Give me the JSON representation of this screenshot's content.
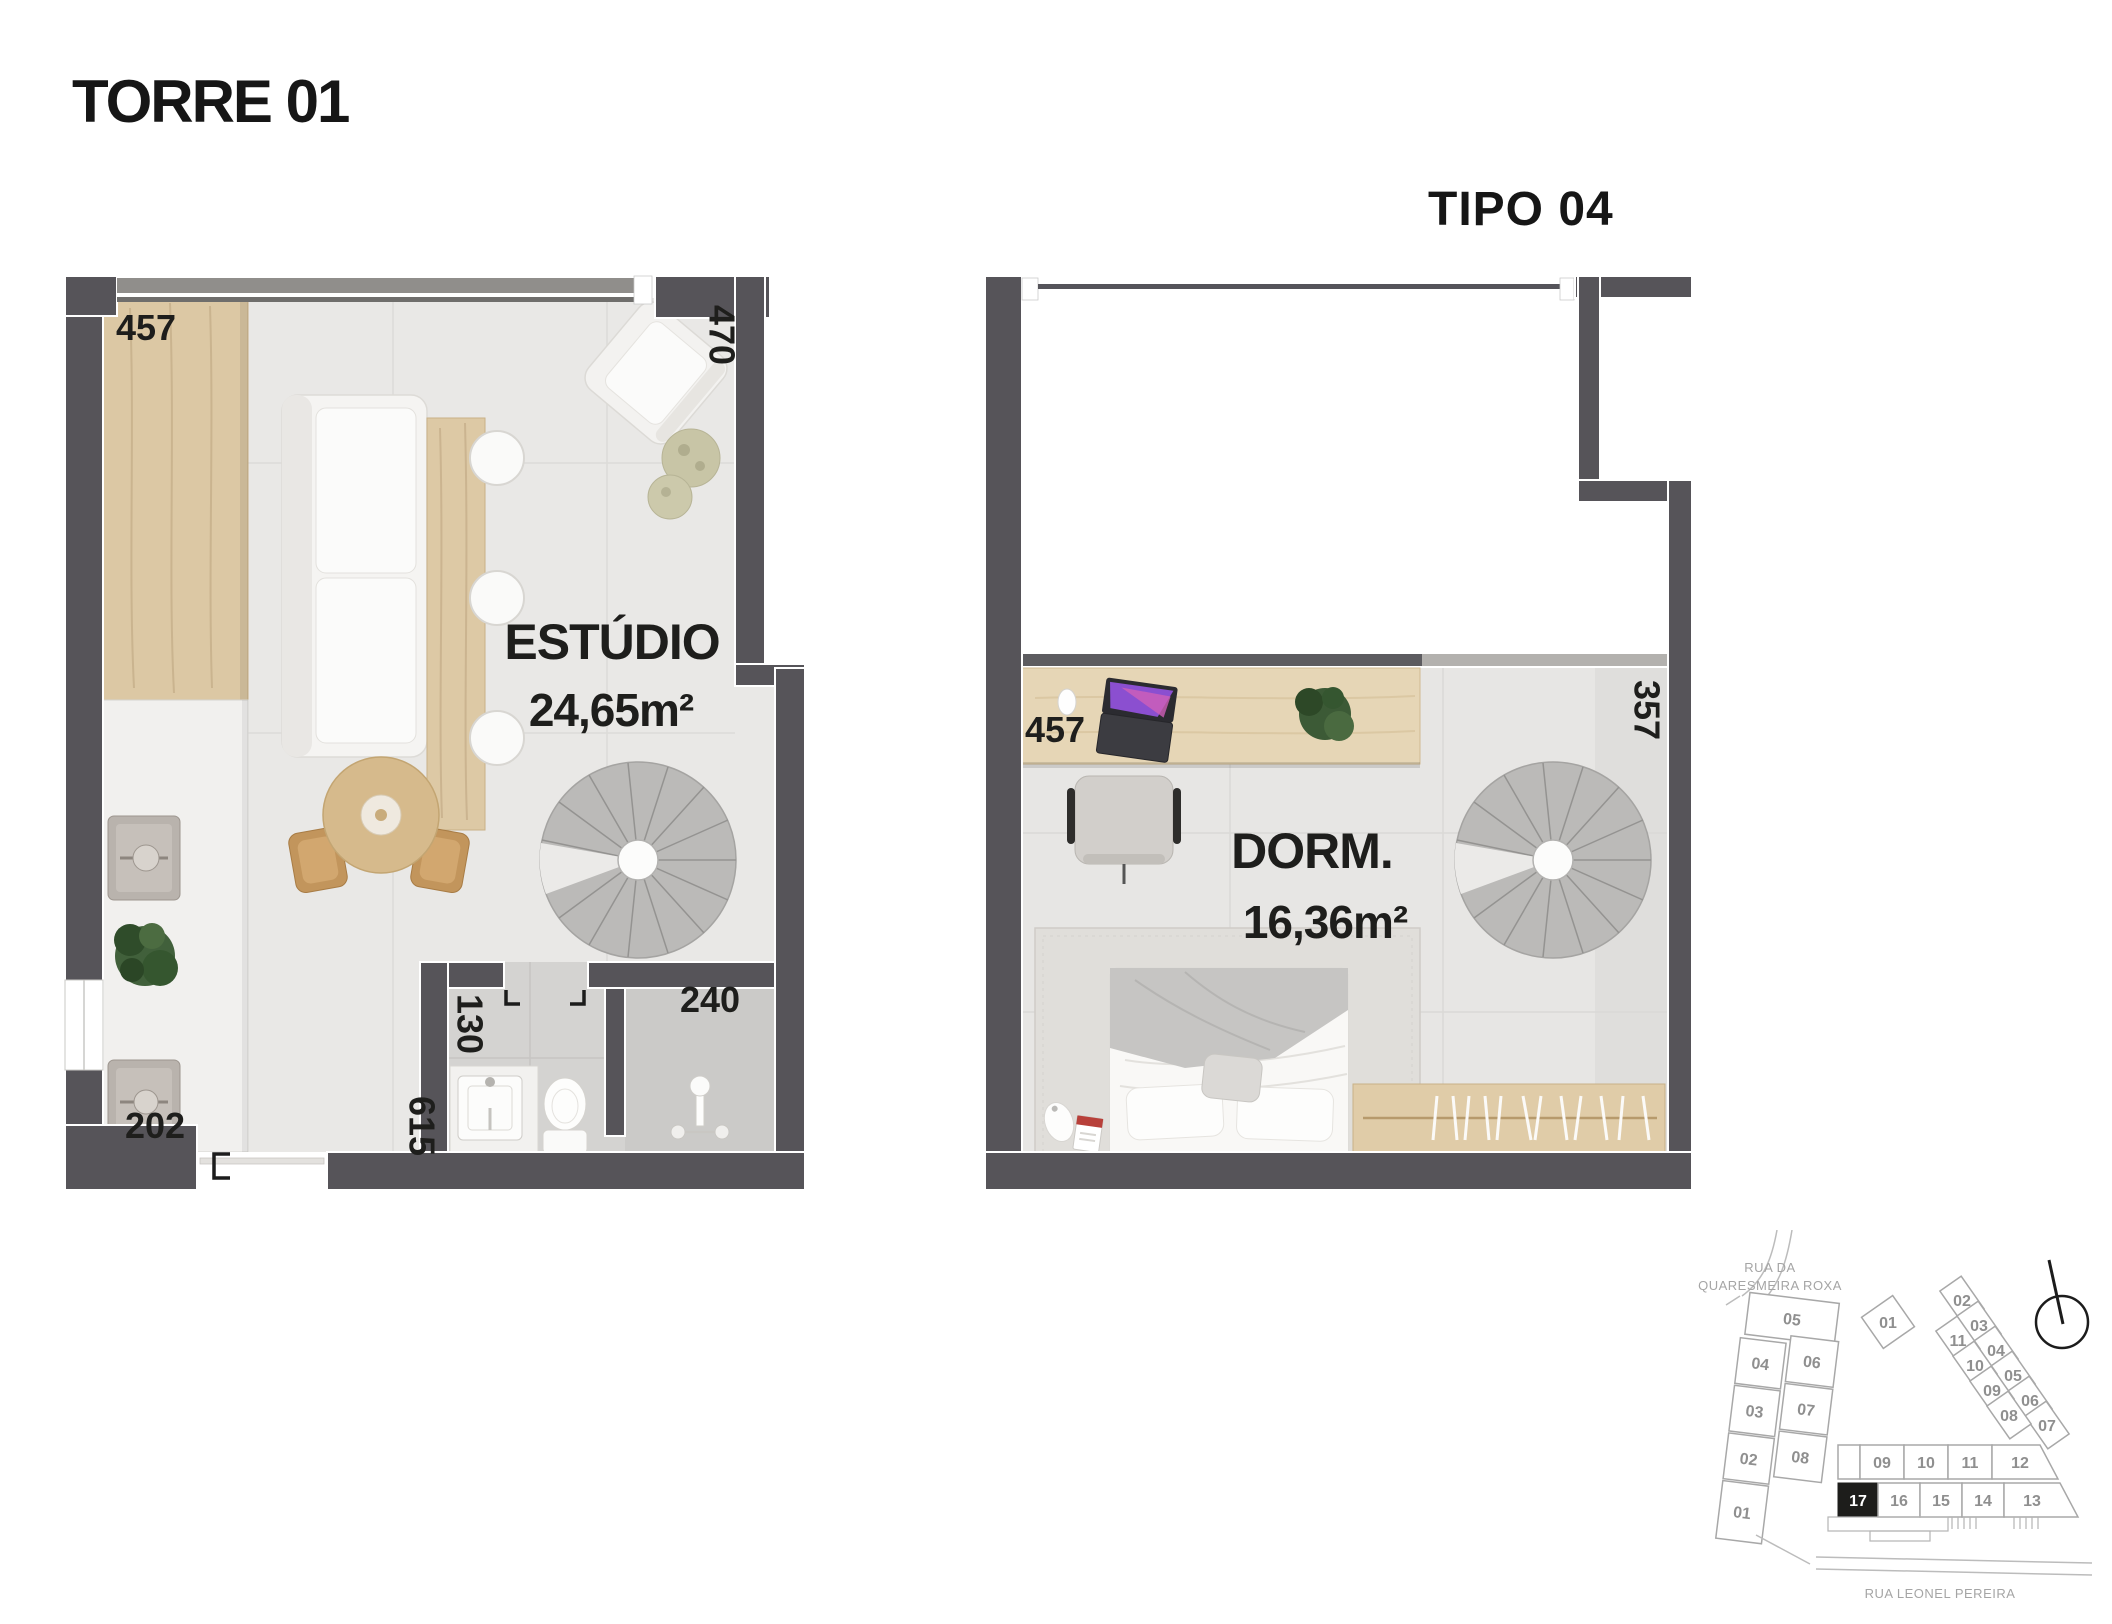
{
  "header": {
    "title": "TORRE 01",
    "type_label": "TIPO 04"
  },
  "studio_plan": {
    "room_label": "ESTÚDIO",
    "room_area": "24,65m²",
    "dim_top_counter": "457",
    "dim_right_wall": "470",
    "dim_bath_door": "130",
    "dim_shower": "240",
    "dim_kitchen_bottom": "202",
    "dim_hall": "615"
  },
  "bedroom_plan": {
    "room_label": "DORM.",
    "room_area": "16,36m²",
    "dim_desk_wall": "457",
    "dim_right_wall": "357"
  },
  "site_plan": {
    "street_top_line1": "RUA DA",
    "street_top_line2": "QUARESMEIRA ROXA",
    "street_bottom": "RUA LEONEL PEREIRA",
    "highlighted_unit": "17",
    "tower_left": {
      "u05": "05",
      "u04": "04",
      "u03": "03",
      "u02": "02",
      "u01": "01",
      "u06": "06",
      "u07": "07",
      "u08": "08"
    },
    "tower_right": {
      "u01": "01",
      "outer": [
        "02",
        "03",
        "04",
        "05",
        "06",
        "07"
      ],
      "inner": [
        "11",
        "10",
        "09",
        "08"
      ]
    },
    "block": {
      "top": [
        "09",
        "10",
        "11",
        "12"
      ],
      "bottom": [
        "17",
        "16",
        "15",
        "14",
        "13"
      ]
    }
  },
  "colors": {
    "wall": "#565459",
    "floor": "#e9e8e6",
    "wood": "#dcc8a4",
    "unit_highlight": "#1d1d1b"
  }
}
